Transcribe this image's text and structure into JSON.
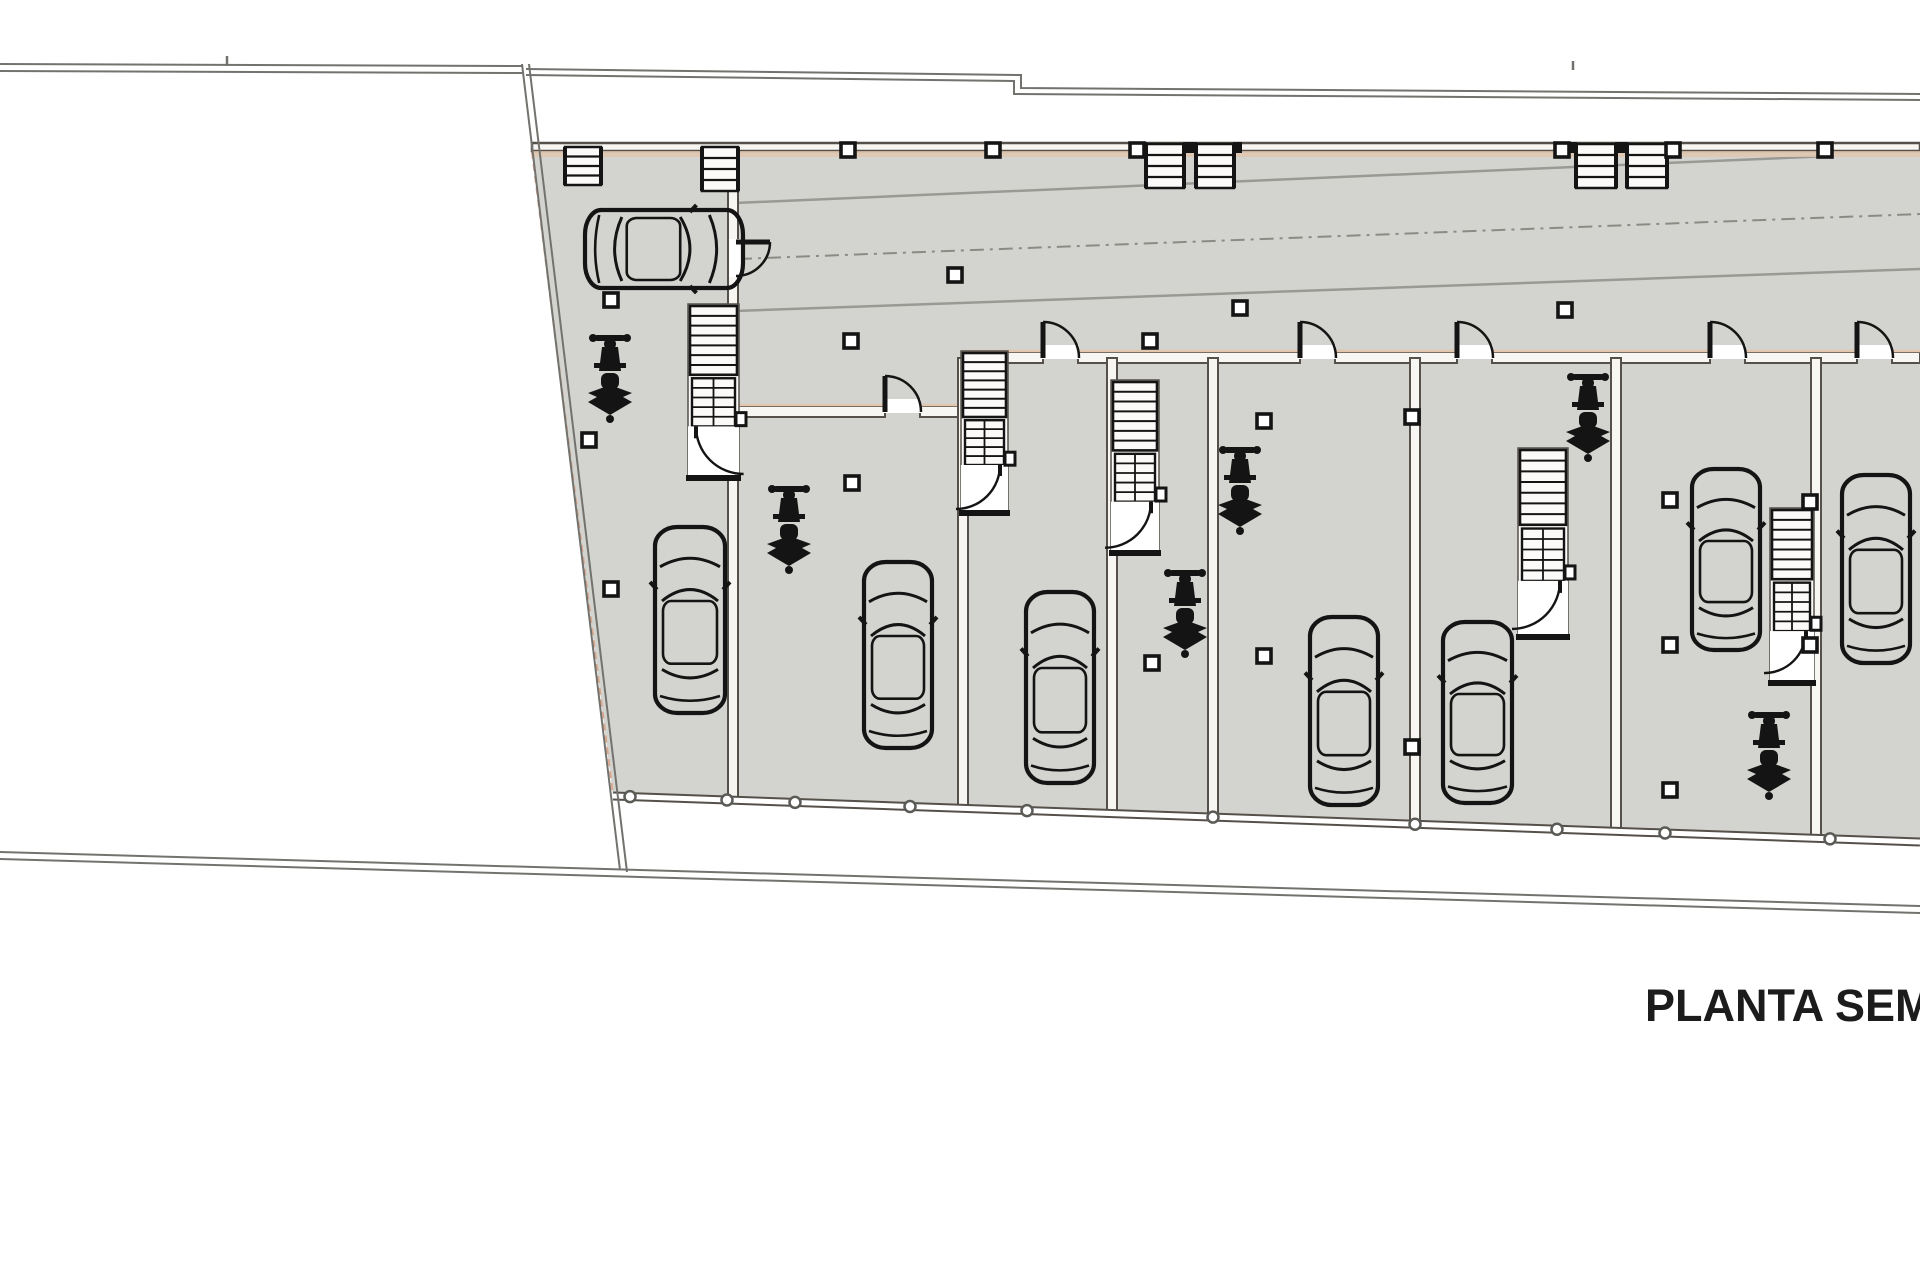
{
  "title": "PLANTA SEMIS",
  "canvas": {
    "w": 1920,
    "h": 1280
  },
  "colors": {
    "floor": "#d3d4cf",
    "wall_fill": "#f8f6f2",
    "wall_edge": "#55504a",
    "peach": "#e2c6ae",
    "peach_dash": "#d9a88f",
    "boundary": "#72726e",
    "ramp_line": "#9a9a95",
    "center_dash": "#8b8b86",
    "symbol": "#141414",
    "node_stroke": "#5a5a56",
    "stair_bg": "#fbfaf8",
    "text": "#1c1c1c"
  },
  "plan": {
    "floor_polygon": [
      [
        532,
        150
      ],
      [
        1920,
        150
      ],
      [
        1920,
        840
      ],
      [
        613,
        796
      ]
    ],
    "boundary_polylines": [
      {
        "id": "boundary-top-left-outer",
        "pts": [
          [
            0,
            64
          ],
          [
            522,
            66
          ]
        ]
      },
      {
        "id": "boundary-top-left-inner",
        "pts": [
          [
            0,
            71
          ],
          [
            524,
            73
          ]
        ]
      },
      {
        "id": "boundary-top-right-outer",
        "pts": [
          [
            526,
            69
          ],
          [
            1021,
            75
          ],
          [
            1021,
            88
          ],
          [
            1920,
            94
          ]
        ]
      },
      {
        "id": "boundary-top-right-inner",
        "pts": [
          [
            526,
            75
          ],
          [
            1014,
            81
          ],
          [
            1014,
            94
          ],
          [
            1920,
            100
          ]
        ]
      },
      {
        "id": "boundary-left-slant-outer",
        "pts": [
          [
            522,
            64
          ],
          [
            620,
            870
          ]
        ]
      },
      {
        "id": "boundary-left-slant-inner",
        "pts": [
          [
            529,
            64
          ],
          [
            627,
            872
          ]
        ]
      },
      {
        "id": "boundary-bottom-outer",
        "pts": [
          [
            0,
            852
          ],
          [
            1920,
            906
          ]
        ]
      },
      {
        "id": "boundary-bottom-inner",
        "pts": [
          [
            0,
            859
          ],
          [
            1920,
            913
          ]
        ]
      }
    ],
    "ticks": [
      [
        227,
        56,
        227,
        66
      ],
      [
        1573,
        61,
        1573,
        70
      ]
    ],
    "floor_edge_dash": {
      "x1": 532,
      "y1": 152,
      "x2": 613,
      "y2": 794
    },
    "ramp_lines": [
      {
        "x1": 735,
        "y1": 203,
        "x2": 1830,
        "y2": 156
      },
      {
        "x1": 735,
        "y1": 311,
        "x2": 1920,
        "y2": 269
      }
    ],
    "center_dash_line": {
      "x1": 738,
      "y1": 259,
      "x2": 1920,
      "y2": 214
    },
    "top_wall": {
      "x": 532,
      "y": 143,
      "w": 1388,
      "h": 8
    },
    "top_wall_peach": {
      "x": 532,
      "y": 151,
      "w": 1388,
      "h": 6
    },
    "unit_walls": [
      {
        "x": 963,
        "y": 352,
        "w": 80,
        "h": 11
      },
      {
        "x": 1078,
        "y": 352,
        "w": 222,
        "h": 11
      },
      {
        "x": 1335,
        "y": 352,
        "w": 122,
        "h": 11
      },
      {
        "x": 1492,
        "y": 352,
        "w": 218,
        "h": 11
      },
      {
        "x": 1745,
        "y": 352,
        "w": 112,
        "h": 11
      },
      {
        "x": 1892,
        "y": 352,
        "w": 28,
        "h": 11
      }
    ],
    "u2_walls": [
      {
        "x": 733,
        "y": 406,
        "w": 152,
        "h": 11
      },
      {
        "x": 920,
        "y": 406,
        "w": 43,
        "h": 11
      }
    ],
    "dividers": [
      {
        "x": 733,
        "y0": 150,
        "y1": 800
      },
      {
        "x": 963,
        "y0": 358,
        "y1": 806
      },
      {
        "x": 1112,
        "y0": 358,
        "y1": 812
      },
      {
        "x": 1213,
        "y0": 358,
        "y1": 817
      },
      {
        "x": 1415,
        "y0": 358,
        "y1": 824
      },
      {
        "x": 1616,
        "y0": 358,
        "y1": 831
      },
      {
        "x": 1816,
        "y0": 358,
        "y1": 838
      }
    ],
    "bottom_wall": {
      "x1": 613,
      "y1": 796,
      "x2": 1920,
      "y2": 842
    },
    "node_circles_x": [
      630,
      727,
      795,
      910,
      1027,
      1213,
      1415,
      1557,
      1665,
      1830
    ],
    "cars": [
      {
        "id": "car-1",
        "x": 583,
        "y": 208,
        "w": 162,
        "h": 82,
        "rot": "h"
      },
      {
        "id": "car-2",
        "x": 653,
        "y": 525,
        "w": 74,
        "h": 190,
        "rot": "v"
      },
      {
        "id": "car-3",
        "x": 862,
        "y": 560,
        "w": 72,
        "h": 190,
        "rot": "v"
      },
      {
        "id": "car-4",
        "x": 1024,
        "y": 590,
        "w": 72,
        "h": 195,
        "rot": "v"
      },
      {
        "id": "car-5",
        "x": 1308,
        "y": 615,
        "w": 72,
        "h": 192,
        "rot": "v"
      },
      {
        "id": "car-6",
        "x": 1441,
        "y": 620,
        "w": 73,
        "h": 185,
        "rot": "v"
      },
      {
        "id": "car-7",
        "x": 1690,
        "y": 467,
        "w": 72,
        "h": 185,
        "rot": "v"
      },
      {
        "id": "car-8",
        "x": 1840,
        "y": 473,
        "w": 72,
        "h": 192,
        "rot": "v"
      }
    ],
    "motorcycles": [
      {
        "cx": 610,
        "cy": 335
      },
      {
        "cx": 789,
        "cy": 486
      },
      {
        "cx": 1185,
        "cy": 570
      },
      {
        "cx": 1240,
        "cy": 447
      },
      {
        "cx": 1588,
        "cy": 374
      },
      {
        "cx": 1769,
        "cy": 712
      }
    ],
    "stairs": [
      {
        "id": "stair-unit-1",
        "x": 690,
        "y": 306,
        "w": 47,
        "h": 172,
        "door": "right"
      },
      {
        "id": "stair-unit-3",
        "x": 963,
        "y": 353,
        "w": 43,
        "h": 160,
        "door": "left"
      },
      {
        "id": "stair-unit-4",
        "x": 1113,
        "y": 382,
        "w": 44,
        "h": 171,
        "door": "left"
      },
      {
        "id": "stair-unit-6",
        "x": 1520,
        "y": 450,
        "w": 46,
        "h": 187,
        "door": "left"
      },
      {
        "id": "stair-unit-7",
        "x": 1772,
        "y": 510,
        "w": 40,
        "h": 173,
        "door": "left"
      }
    ],
    "ladders": [
      {
        "x": 565,
        "y": 147,
        "w": 36,
        "h": 38,
        "posts": false
      },
      {
        "x": 702,
        "y": 147,
        "w": 36,
        "h": 44,
        "posts": false
      },
      {
        "x": 1146,
        "y": 144,
        "w": 38,
        "h": 44,
        "posts": true
      },
      {
        "x": 1196,
        "y": 144,
        "w": 38,
        "h": 44,
        "posts": true
      },
      {
        "x": 1576,
        "y": 144,
        "w": 40,
        "h": 44,
        "posts": true
      },
      {
        "x": 1627,
        "y": 144,
        "w": 40,
        "h": 44,
        "posts": true
      }
    ],
    "doors": [
      {
        "x": 1043,
        "y": 358,
        "o": "up"
      },
      {
        "x": 1300,
        "y": 358,
        "o": "up"
      },
      {
        "x": 1457,
        "y": 358,
        "o": "up"
      },
      {
        "x": 1710,
        "y": 358,
        "o": "up"
      },
      {
        "x": 1857,
        "y": 358,
        "o": "up"
      },
      {
        "x": 885,
        "y": 412,
        "o": "up"
      },
      {
        "x": 733,
        "y": 242,
        "o": "side"
      }
    ],
    "columns": [
      [
        848,
        150
      ],
      [
        993,
        150
      ],
      [
        1137,
        150
      ],
      [
        1562,
        150
      ],
      [
        1673,
        150
      ],
      [
        1825,
        150
      ],
      [
        851,
        341
      ],
      [
        1150,
        341
      ],
      [
        955,
        275
      ],
      [
        1240,
        308
      ],
      [
        1565,
        310
      ],
      [
        611,
        300
      ],
      [
        589,
        440
      ],
      [
        611,
        589
      ],
      [
        852,
        483
      ],
      [
        1264,
        421
      ],
      [
        1264,
        656
      ],
      [
        1152,
        663
      ],
      [
        1412,
        417
      ],
      [
        1412,
        747
      ],
      [
        1670,
        500
      ],
      [
        1670,
        645
      ],
      [
        1670,
        790
      ],
      [
        1810,
        502
      ],
      [
        1810,
        645
      ]
    ]
  }
}
